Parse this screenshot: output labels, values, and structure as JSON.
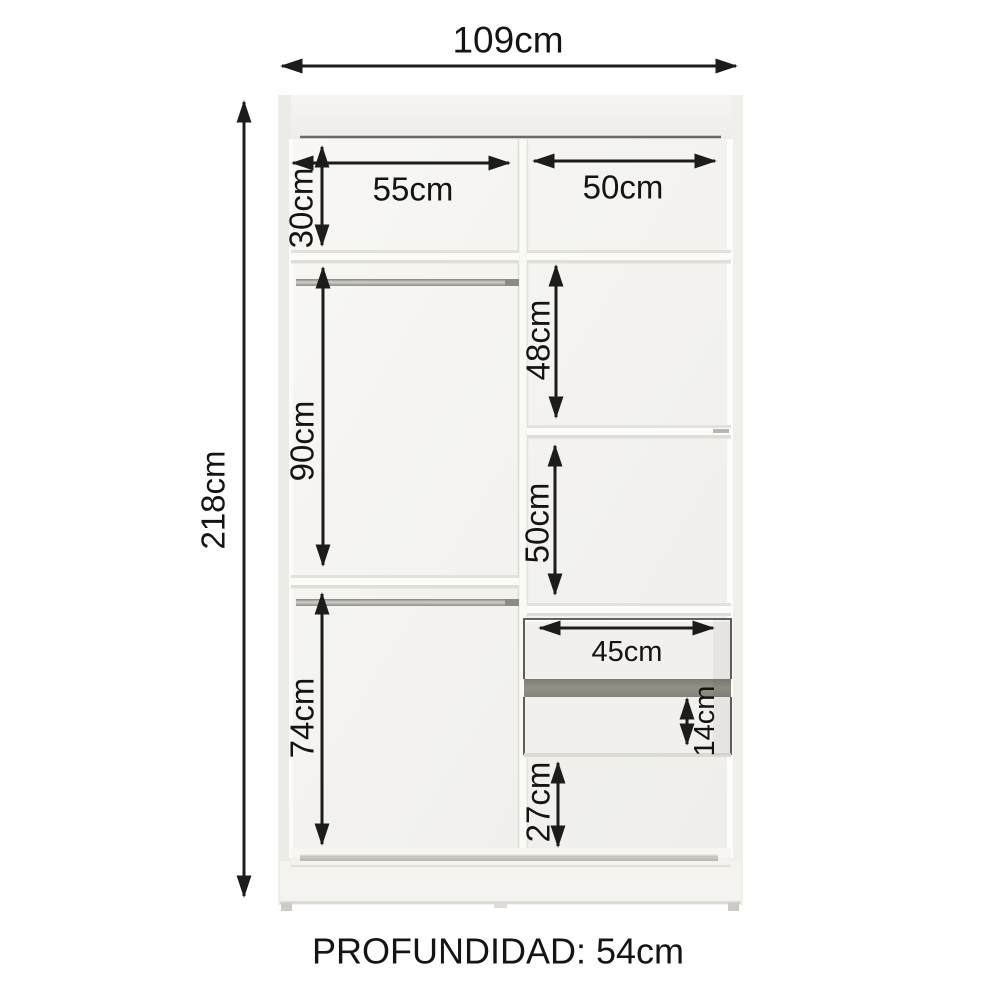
{
  "dims": {
    "total_width": "109cm",
    "total_height": "218cm",
    "top_shelf_height": "30cm",
    "left_section_width": "55cm",
    "right_section_width": "50cm",
    "left_hanging_height": "90cm",
    "right_upper_shelf_height": "48cm",
    "right_middle_shelf_height": "50cm",
    "left_lower_height": "74cm",
    "drawer_width": "45cm",
    "drawer_height": "14cm",
    "bottom_section_height": "27cm"
  },
  "depth_note": "PROFUNDIDAD: 54cm",
  "colors": {
    "line": "#1c1c1b",
    "cabinet_face": "#f5f4f0",
    "cabinet_shadow": "#e2e0db",
    "rod": "#a9a8a3",
    "drawer_gap": "#8e8c82",
    "bottom_rail": "#c8c6bf"
  }
}
